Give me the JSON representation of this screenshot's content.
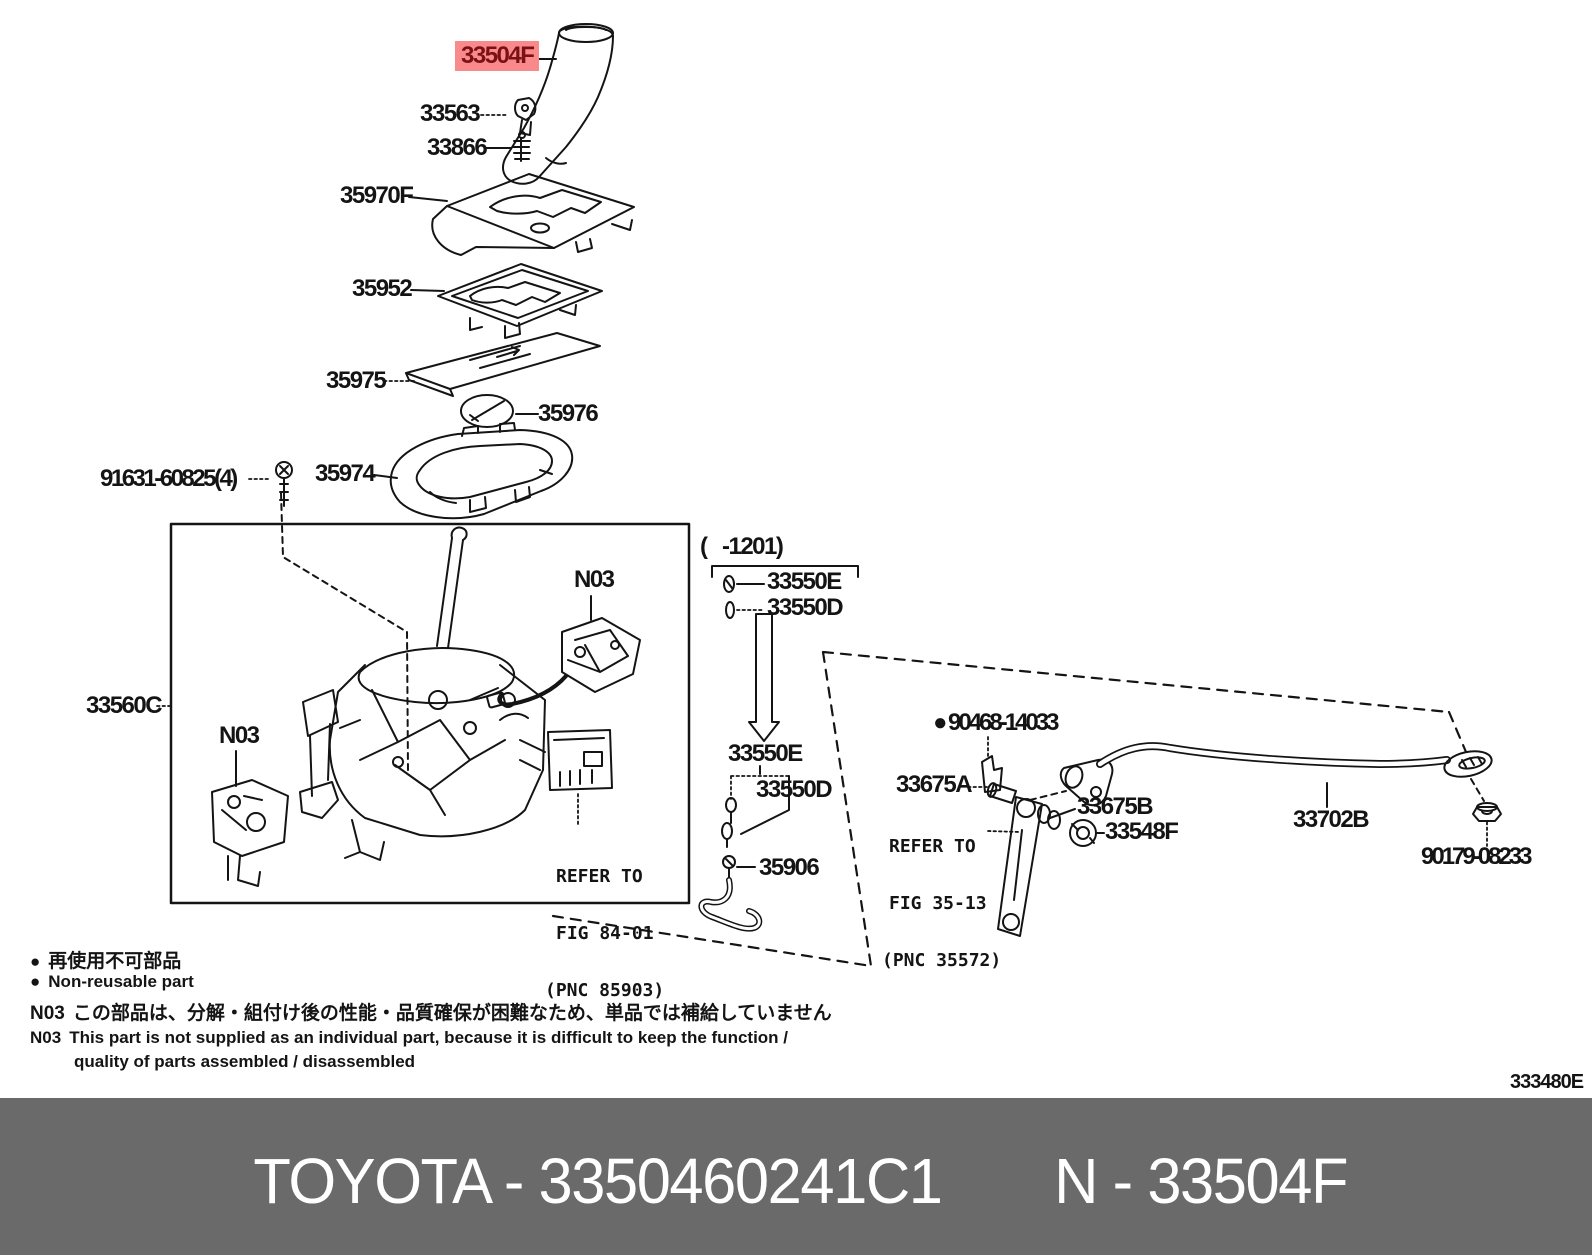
{
  "highlight": {
    "label": "33504F",
    "bg": "#f9898b",
    "fg": "#7a1113"
  },
  "labels": {
    "p33563": "33563",
    "p33866": "33866",
    "p35970F": "35970F",
    "p35952": "35952",
    "p35975": "35975",
    "p35976": "35976",
    "p91631": "91631-60825(4)",
    "p35974": "35974",
    "p33560C": "33560C",
    "n03": "N03",
    "range1201": "(   -1201)",
    "p33550E": "33550E",
    "p33550D": "33550D",
    "p35906": "35906",
    "p90468": "90468-14033",
    "p33675A": "33675A",
    "p33675B": "33675B",
    "p33548F": "33548F",
    "p33702B": "33702B",
    "p90179": "90179-08233"
  },
  "refer84": {
    "l1": "REFER TO",
    "l2": "FIG 84-01",
    "l3": "(PNC 85903)"
  },
  "refer35": {
    "l1": "REFER TO",
    "l2": "FIG 35-13",
    "l3": "(PNC 35572)"
  },
  "legend": {
    "bullet": "●",
    "jp_nonreusable": "再使用不可部品",
    "en_nonreusable": "Non-reusable part",
    "n03": "N03",
    "jp_note": "この部品は、分解・組付け後の性能・品質確保が困難なため、単品では補給していません",
    "en_note1": "This part is not supplied as an individual part, because it is difficult to keep the function /",
    "en_note2": "quality of parts assembled / disassembled"
  },
  "docnum": "333480E",
  "footer": {
    "left": "TOYOTA - 3350460241C1",
    "right": "N - 33504F",
    "bg": "#6a6a6a"
  },
  "line_color": "#141414"
}
